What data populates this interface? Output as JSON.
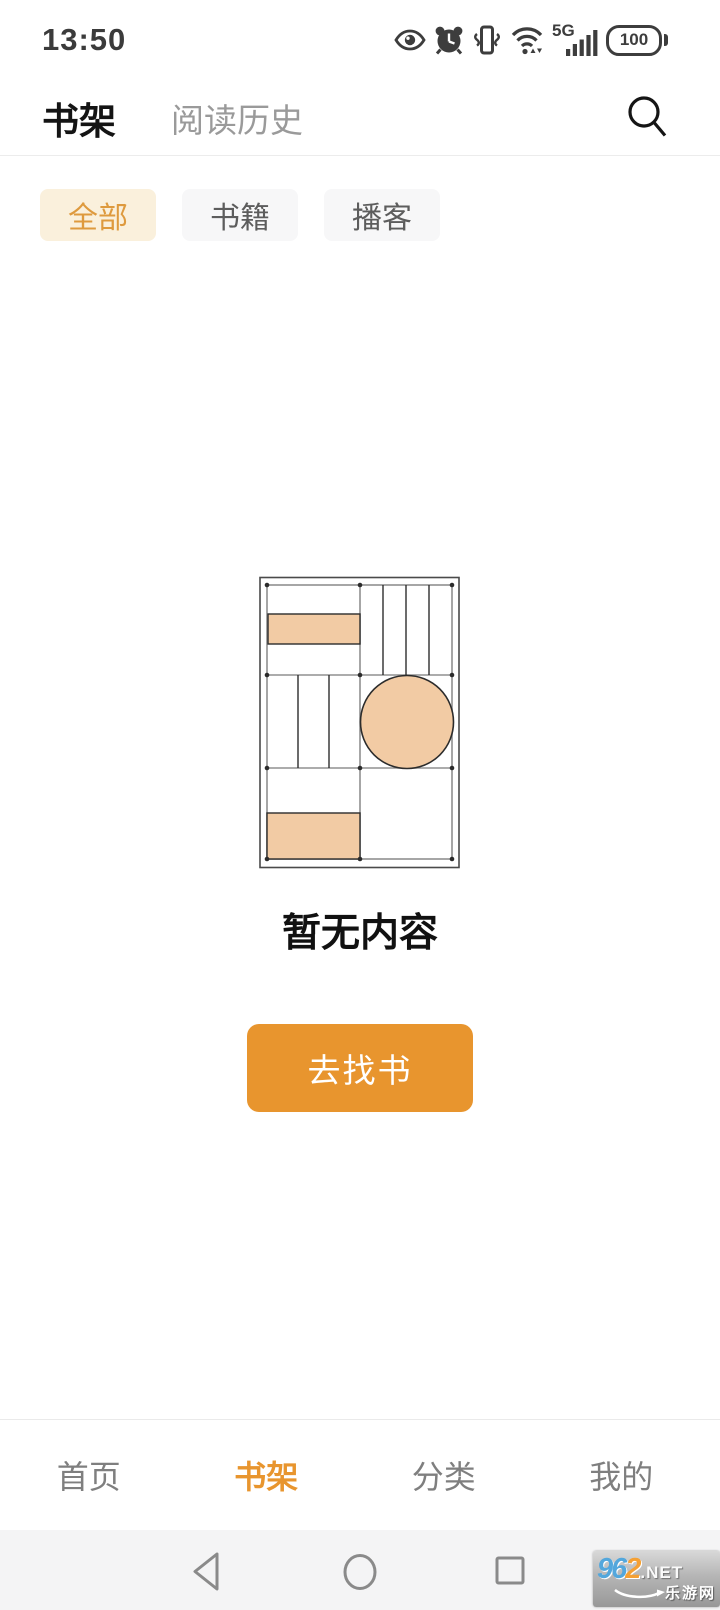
{
  "status_bar": {
    "time": "13:50",
    "network": "5G",
    "battery": "100",
    "icons": [
      "eye-icon",
      "alarm-clock-icon",
      "vibrate-icon",
      "wifi-icon",
      "signal-5g-icon",
      "battery-icon"
    ]
  },
  "header": {
    "tabs": [
      {
        "label": "书架",
        "active": true
      },
      {
        "label": "阅读历史",
        "active": false
      }
    ],
    "search_icon": "search-icon"
  },
  "filters": {
    "items": [
      {
        "label": "全部",
        "active": true
      },
      {
        "label": "书籍",
        "active": false
      },
      {
        "label": "播客",
        "active": false
      }
    ]
  },
  "empty_state": {
    "message": "暂无内容",
    "action": "去找书"
  },
  "bottom_nav": {
    "items": [
      {
        "label": "首页",
        "active": false
      },
      {
        "label": "书架",
        "active": true
      },
      {
        "label": "分类",
        "active": false
      },
      {
        "label": "我的",
        "active": false
      }
    ]
  },
  "android_nav": {
    "icons": [
      "back-icon",
      "home-icon",
      "recents-icon"
    ]
  },
  "watermark": {
    "number_blue": "96",
    "number_orange": "2",
    "domain": ".NET",
    "site_name": "乐游网"
  },
  "colors": {
    "accent_orange": "#E8952E",
    "chip_active_bg": "#FAF0DC",
    "chip_active_text": "#DE9A3E",
    "illustration_peach": "#F2CBA4",
    "inactive_gray": "#7F7F7F"
  }
}
